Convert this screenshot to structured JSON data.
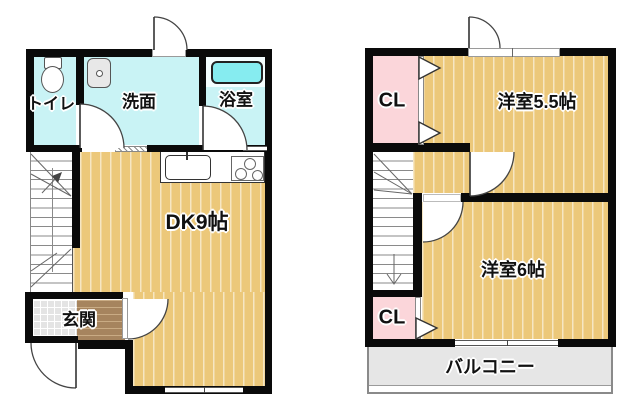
{
  "floor1": {
    "toilet": "トイレ",
    "washroom": "洗面",
    "bathroom": "浴室",
    "dk": "DK9帖",
    "entrance": "玄関"
  },
  "floor2": {
    "closet_top": "CL",
    "room55": "洋室5.5帖",
    "room6": "洋室6帖",
    "closet_bottom": "CL",
    "balcony": "バルコニー"
  },
  "colors": {
    "wall": "#0a0a0a",
    "wood_floor": "#ecc87a",
    "wet_floor": "#c9f3f5",
    "closet_pink": "#fbd6da",
    "bathtub": "#86ecf0",
    "balcony_gray": "#e6e6e6",
    "entrance_tile": "#e4e4e4",
    "entrance_step": "#a6845e"
  }
}
